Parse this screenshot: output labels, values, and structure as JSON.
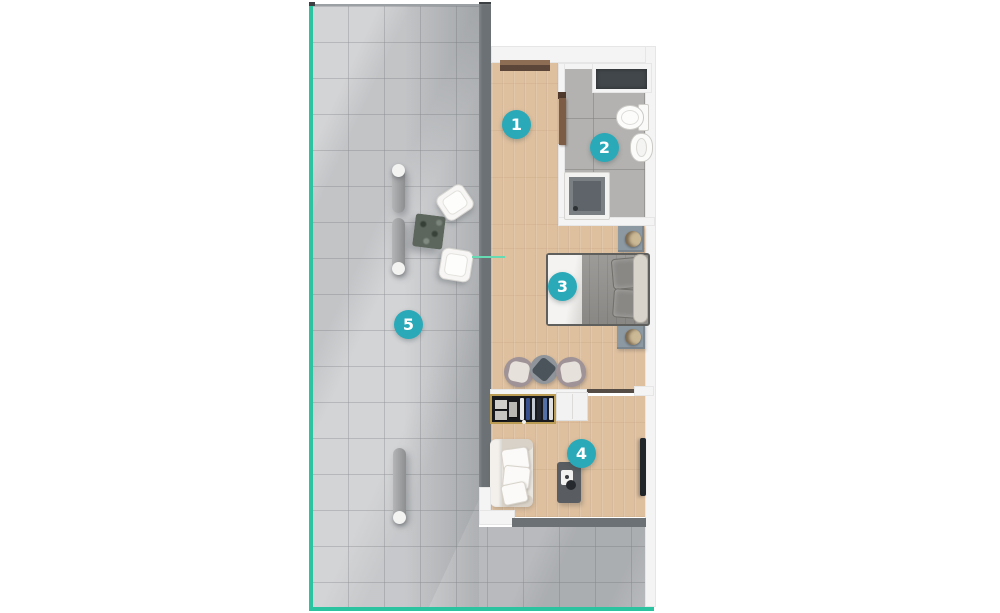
{
  "floor_plan": {
    "markers": [
      {
        "number": "1",
        "area": "hallway"
      },
      {
        "number": "2",
        "area": "bathroom"
      },
      {
        "number": "3",
        "area": "bedroom"
      },
      {
        "number": "4",
        "area": "living-area"
      },
      {
        "number": "5",
        "area": "terrace"
      }
    ],
    "colors": {
      "marker_teal": "#2aa9b8",
      "terrace_border": "#2cc3a0",
      "section_line": "#66dab3",
      "wall_dark": "#6b7174",
      "wood_floor": "#dec09f",
      "terrace_tile": "#d3d4d6",
      "bathroom_tile": "#b3b2b0"
    }
  }
}
